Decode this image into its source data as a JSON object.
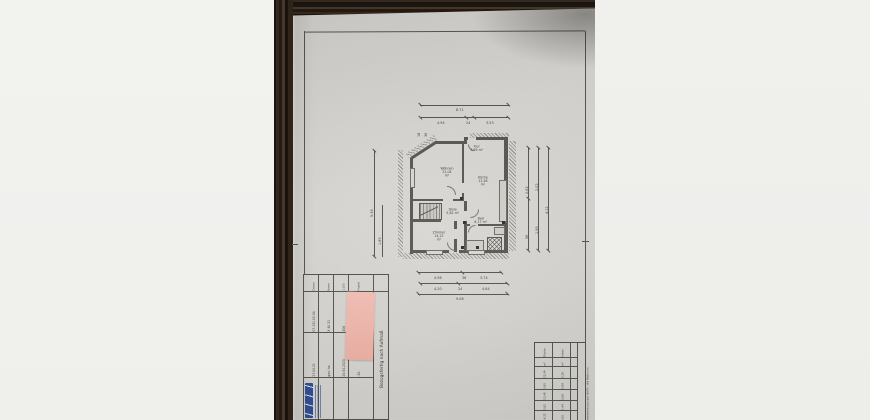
{
  "scene": {
    "surface_color": "#f1f1ee",
    "wood_color": "#2a2118",
    "paper_color": "#d6d5d1",
    "note_color": "#f2bbb0",
    "logo_color": "#2b4d96",
    "line_color": "#4c4b46"
  },
  "plan": {
    "rooms": [
      {
        "name": "Wohnen",
        "area": "21,04 m²"
      },
      {
        "name": "Flur",
        "area": "3,95 m²"
      },
      {
        "name": "Küche",
        "area": "12,46 m²"
      },
      {
        "name": "Diele",
        "area": "5,82 m²"
      },
      {
        "name": "Zimmer",
        "area": "14,22 m²"
      },
      {
        "name": "Bad",
        "area": "6,17 m²"
      }
    ],
    "dims": {
      "top_total": "8.71",
      "top_seg1": "4.94",
      "top_seg2": "24",
      "top_seg3": "3.53",
      "top_micro1": "18",
      "top_micro2": "36",
      "left1": "9.36",
      "left2": "1.89",
      "right1": "2.62",
      "right2": "96",
      "right3": "2.02",
      "right4": "1.99",
      "right5": "4.12",
      "bot1a": "4.98",
      "bot1b": "36",
      "bot1c": "3.74",
      "bot2a": "4.20",
      "bot2b": "24",
      "bot2c": "4.64",
      "bot_total": "9.08"
    }
  },
  "titleblock": {
    "note": "Bezugsfertig nach Aufmaß",
    "col_headers": [
      "Datum",
      "Name",
      "1:100",
      "Projekt"
    ],
    "datum": "27.04.21",
    "gez": "gez. ha",
    "plan_nr": "07.131.02-04",
    "auftrag": "X 40 31",
    "blatt": "306",
    "index": "-20-",
    "datum2": "25.04.2023"
  },
  "area_table": {
    "title": "Wohnflächenberechnung nach WoFlV – alle Maße in m",
    "rowA": [
      "80,54",
      "14,22",
      "5,82",
      "12,46",
      "3,95",
      "21,04",
      "m²",
      "Fläche"
    ],
    "rowB": [
      "20,14",
      "3,55",
      "1,44",
      "3,08",
      "0,99",
      "5,26",
      "m²",
      "Anteil"
    ],
    "rowC": [
      "Σ",
      "6",
      "5",
      "4",
      "3",
      "2",
      "1",
      "Nr."
    ]
  }
}
